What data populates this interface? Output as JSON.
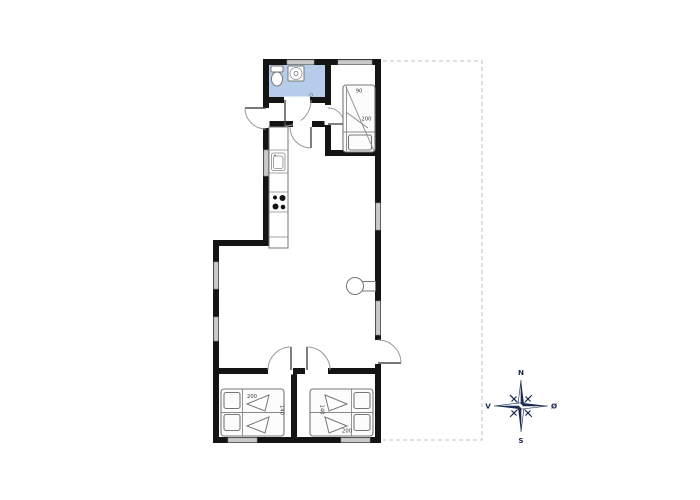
{
  "plan": {
    "beds": {
      "top": {
        "width": "90",
        "length": "200"
      },
      "bottom_left": {
        "width": "140",
        "length": "200"
      },
      "bottom_right": {
        "width": "140",
        "length": "200"
      }
    },
    "compass": {
      "north": "N",
      "south": "S",
      "west": "V",
      "east": "Ø"
    },
    "colors": {
      "wall": "#141414",
      "bathroom_floor": "#b5cdea",
      "window_fill": "#c9c9c9",
      "compass_navy": "#1a2a4e",
      "boundary_dash": "#c2c2c2"
    }
  }
}
